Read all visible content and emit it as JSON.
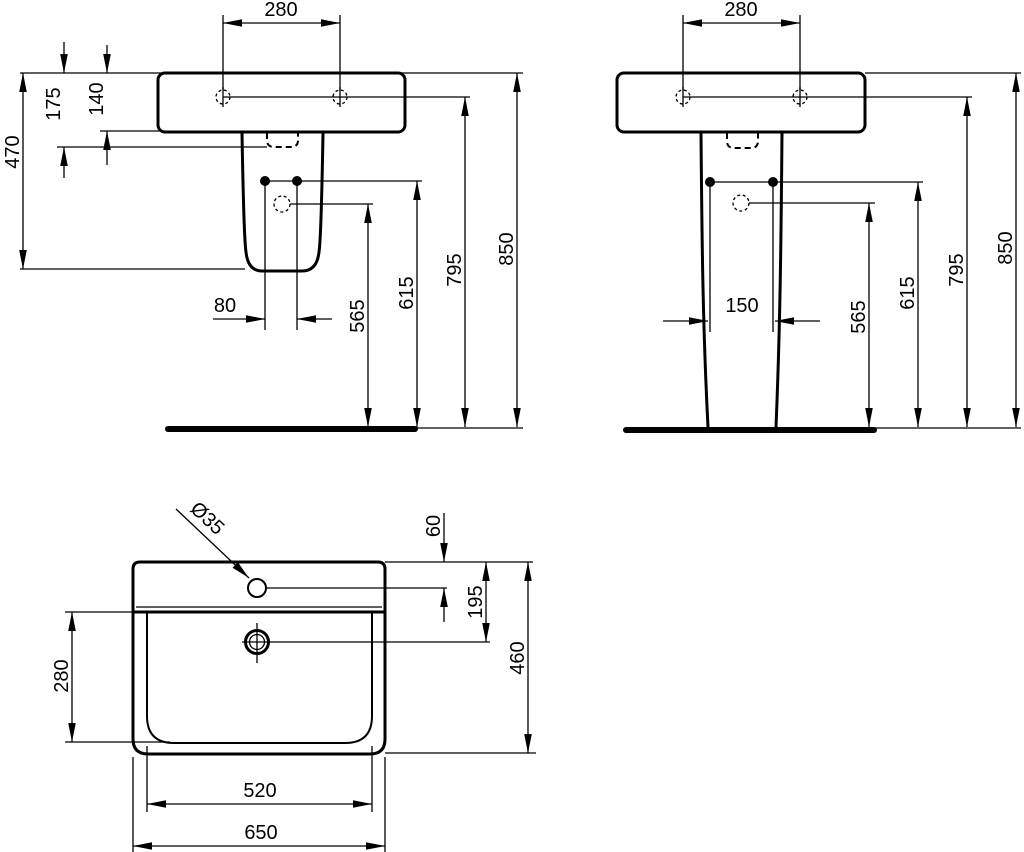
{
  "colors": {
    "ink": "#000000",
    "background": "#ffffff"
  },
  "side_view": {
    "hole_spacing_top": "280",
    "rim_to_trap": "175",
    "rim_to_basin_bottom": "140",
    "rim_to_pedestal_bottom": "470",
    "bolt_hole_spacing": "80",
    "drain_outlet_height": "565",
    "bolt_hole_height": "615",
    "fixing_hole_height": "795",
    "rim_height": "850"
  },
  "front_view": {
    "hole_spacing_top": "280",
    "bolt_hole_spacing": "150",
    "drain_outlet_height": "565",
    "bolt_hole_height": "615",
    "fixing_hole_height": "795",
    "rim_height": "850"
  },
  "plan_view": {
    "faucet_hole_diameter": "Ø35",
    "faucet_hole_offset": "60",
    "drain_offset": "195",
    "bowl_depth": "280",
    "overall_depth": "460",
    "bowl_width": "520",
    "overall_width": "650"
  }
}
